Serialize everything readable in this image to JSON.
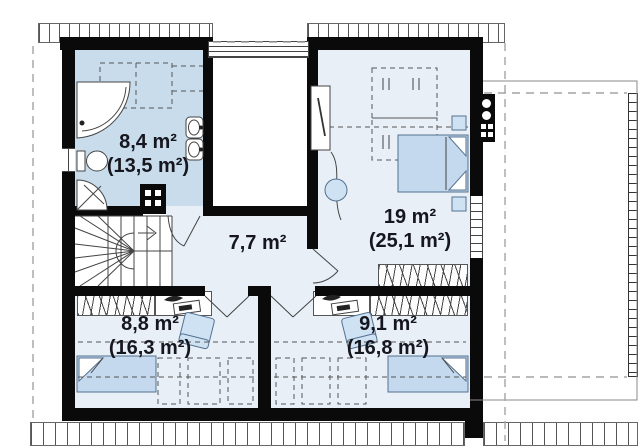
{
  "plan": {
    "type": "floor-plan-attic-storey",
    "rooms": [
      {
        "id": "bathroom",
        "area": "8,4 m²",
        "total": "(13,5 m²)"
      },
      {
        "id": "bedroom-large",
        "area": "19 m²",
        "total": "(25,1 m²)"
      },
      {
        "id": "hall",
        "area": "7,7 m²",
        "total": ""
      },
      {
        "id": "bedroom-bottom-left",
        "area": "8,8 m²",
        "total": "(16,3 m²)"
      },
      {
        "id": "bedroom-bottom-right",
        "area": "9,1 m²",
        "total": "(16,8 m²)"
      }
    ],
    "colors": {
      "wall": "#0a0a0a",
      "bathroom_fill": "#c8dcec",
      "room_fill": "#e9eff7",
      "furniture_fill": "#cfe2f4",
      "bed_fill": "#c5d9ee",
      "furniture_outline": "#54718f",
      "label_text": "#16161e"
    },
    "symbols": [
      "corner-bathtub",
      "shower",
      "toilet",
      "sink",
      "double-bed",
      "single-bed",
      "wardrobe",
      "desk",
      "office-chair",
      "armchair",
      "nightstand",
      "winder-stairs",
      "chimney",
      "window",
      "balcony-railing",
      "roof-eave",
      "door-swing"
    ]
  }
}
